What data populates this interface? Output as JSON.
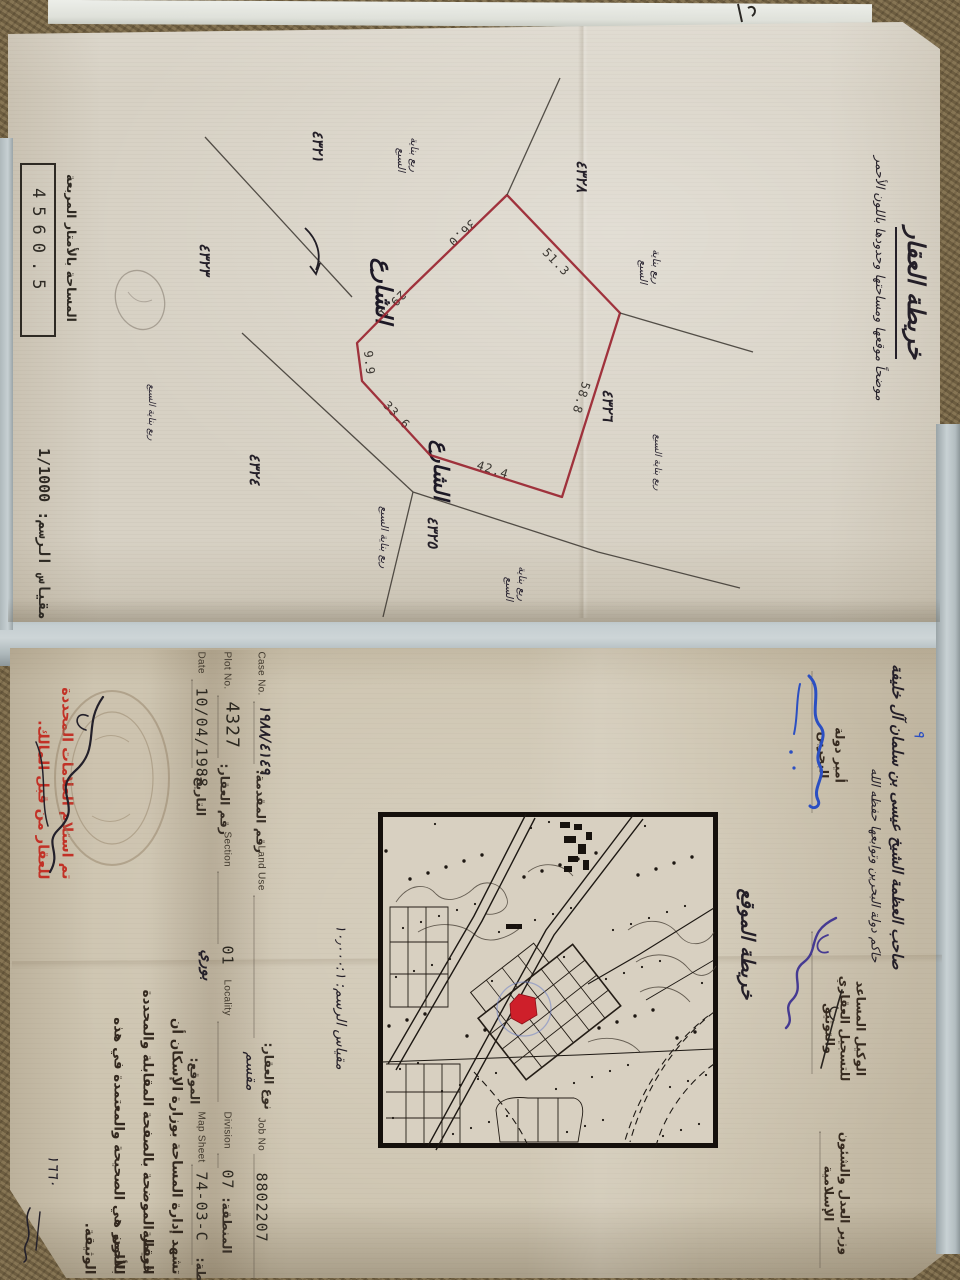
{
  "survey_plat": {
    "heading_ar": "خريطة العقار",
    "subheading_ar": "موضحاً موقعها ومساحتها وحدودها باللون الأحمر",
    "area_stamp": {
      "value": "4560.5",
      "label_ar": "المساحة بالأمتار المربعة"
    },
    "scale_text": "مقياس الرسم: 1/1000",
    "street_label_ar": "الشارع",
    "measurements": {
      "m36": "36.0",
      "m51": "51.3",
      "m29": "29.1",
      "m9": "9.9",
      "m33": "33.6",
      "m42": "42.4",
      "m58": "58.8"
    },
    "plot_numbers": {
      "p4321": "٤٣٢١",
      "p4323": "٤٣٢٣",
      "p4324": "٤٣٢٤",
      "p4325": "٤٣٢٥",
      "p4326": "٤٣٢٦",
      "p4328": "٤٣٢٨"
    },
    "neighbor_note_ar": "ريع بناية السبع"
  },
  "certificate": {
    "owner_line1_ar": "صاحب العظمة الشيخ عيسى بن سلمان آل خليفة",
    "owner_line2_ar": "حاكم دولة البحرين وتوابعها حفظه الله",
    "emir_title_ar": "أمير دولة البحرين",
    "registrar_title_ar": "الوكيل المساعد للتسجيل العقاري والتوثيق",
    "minister_title_ar": "وزير العدل والشئون الإسلامية",
    "fields": {
      "case_no": {
        "en": "Case No.",
        "value": "١٩٨٨/٤١٤٩",
        "ar": "رقم المقدمة:"
      },
      "land_use": {
        "en": "Land Use",
        "value": "مقسم",
        "ar": "نوع العقار:"
      },
      "job_no": {
        "en": "Job No",
        "value": "8802207"
      },
      "plot_no": {
        "en": "Plot No.",
        "value": "4327",
        "ar": "رقم العقار:"
      },
      "section": {
        "en": "Section",
        "value": "01"
      },
      "locality": {
        "en": "Locality",
        "value": "بوري",
        "ar": "الموقع:"
      },
      "division": {
        "en": "Division",
        "value": "07",
        "ar": "المنطقة:"
      },
      "date": {
        "en": "Date",
        "value": "10/04/1988",
        "ar": "التاريخ:"
      },
      "map_sheet": {
        "en": "Map Sheet",
        "value": "74-03-C",
        "ar": "خريطة:"
      }
    },
    "location_map_label_ar": "خريطة الموقع",
    "map_scale_ar": "مقياس الرسم: ١٠٫٠٠٠:١",
    "attestation_ar": {
      "l1": "تشهد إدارة المساحة بوزارة الإسكان أن خريطة",
      "l2": "العقار الموضحة بالصفحة المقابلة والمحددة باللون",
      "l3": "الأحمر هي الصحيحة والمعتمدة في هذه الوثيقة."
    },
    "handover_stamp_ar": {
      "l1": "تم استلام العلامات المحددة",
      "l2": "للعقار من قبل المالك."
    },
    "margin_number": "١٦٦٠",
    "margin_mark": "٩"
  },
  "colors": {
    "boundary_red": "#9a2430",
    "stamp_red": "#c22a20",
    "plot_fill_red": "#ce1f2a",
    "signature_blue": "#2b4fc2",
    "signature_purple": "#453a92"
  }
}
